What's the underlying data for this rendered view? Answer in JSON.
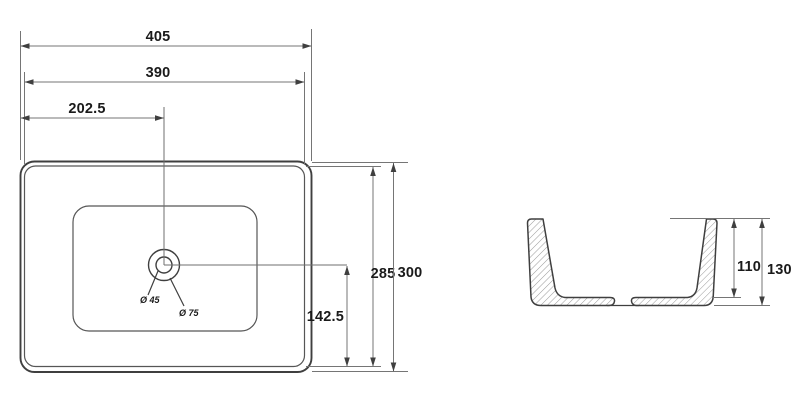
{
  "drawing_type": "sink-technical-drawing",
  "top_view": {
    "labels": {
      "overall_width": "405",
      "rim_inner_width": "390",
      "drain_center_from_left": "202.5",
      "rim_inner_depth": "285",
      "overall_depth": "300",
      "drain_center_from_bottom": "142.5",
      "drain_hole_diameter": "Ø 45",
      "drain_recess_diameter": "Ø 75"
    }
  },
  "side_view": {
    "labels": {
      "inner_height": "110",
      "overall_height": "130"
    }
  },
  "colors": {
    "background": "#ffffff",
    "object_line": "#3f3f3f",
    "secondary_line": "#5a5a5a",
    "dimension_line": "#757575",
    "hatch_line": "#9a9a9a",
    "text": "#1a1a1a"
  }
}
